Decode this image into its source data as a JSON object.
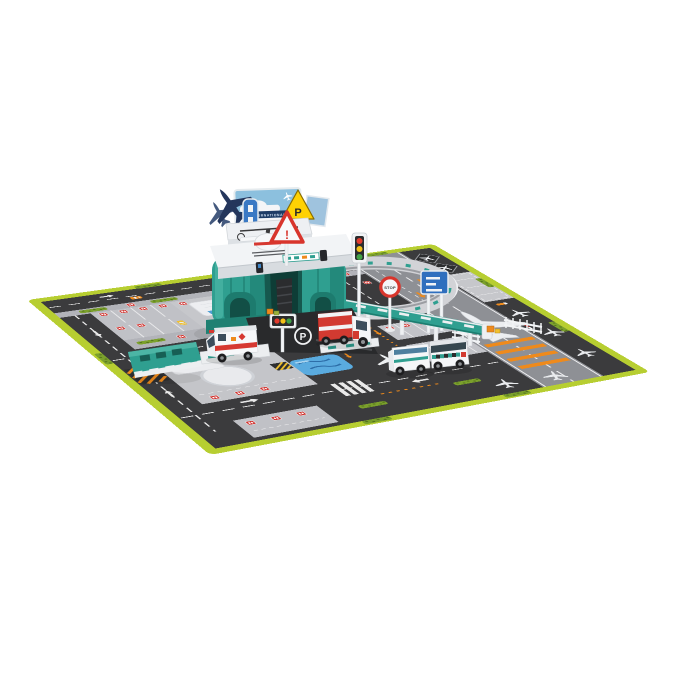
{
  "photo": {
    "type": "product photo",
    "subject": "Toy international airport parking-garage playset with helicopter, signboards, emergency vehicles and a printed roadway play mat",
    "background_color": "#ffffff"
  },
  "playset": {
    "billboard": {
      "line1": "INTERNATIONAL",
      "line2": "AIRPORT",
      "line2_color": "#d9352c",
      "sky_color": "#8cc0de"
    },
    "parking_triangle_sign": {
      "symbol": "P",
      "color": "#ffd103"
    },
    "warning_sign": {
      "symbol": "!",
      "color": "#d8352c"
    },
    "stop_sign": {
      "text": "STOP"
    },
    "ground_parking_marking": "P",
    "traffic_light_colors": [
      "#e23b2e",
      "#f2c018",
      "#41a146"
    ],
    "plastic_teal": "#2f9f90",
    "plastic_white": "#f2f4f6"
  },
  "mat": {
    "border_color": "#b7ce31",
    "asphalt_color": "#3b3b3d",
    "runway_color": "#8e9095",
    "apron_color": "#c6c7cb",
    "marking_white": "#ececee",
    "marking_orange": "#ee8a1c",
    "hedge_green": "#7ba02c",
    "pond_blue": "#5aabdf",
    "sign_red": "#d0312d",
    "features": "main runway with jet silhouette, taxiways, terminal aprons, numbered car parks, pond, hedges, hazard zones, aircraft stands"
  },
  "vehicles": [
    {
      "name": "rescue ambulance",
      "colors": "white with red stripe"
    },
    {
      "name": "container truck",
      "colors": "white cab, red container"
    },
    {
      "name": "airport service truck",
      "colors": "white"
    },
    {
      "name": "security van",
      "colors": "white with teal checker band"
    }
  ],
  "helicopter": {
    "colors": "white with red stripe"
  }
}
